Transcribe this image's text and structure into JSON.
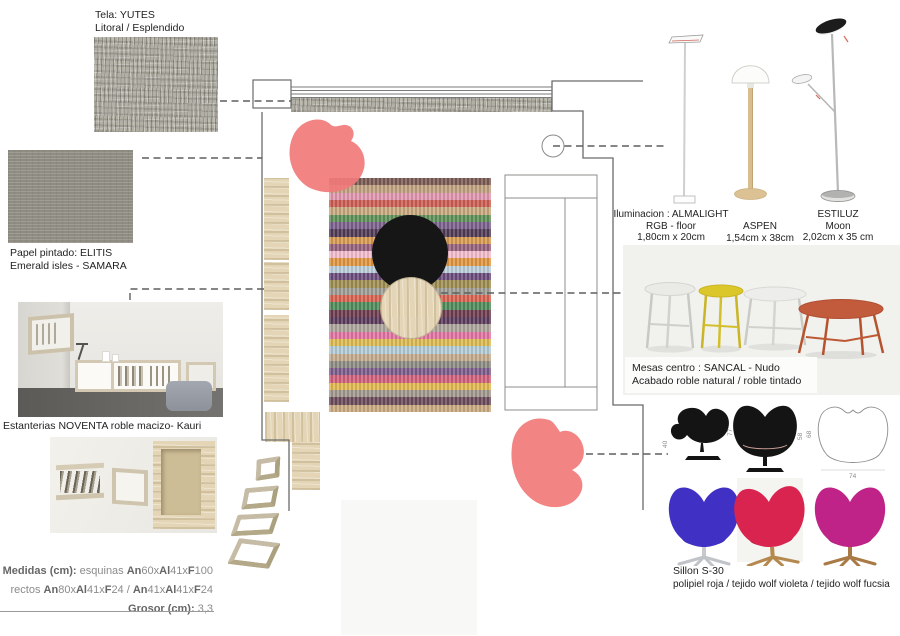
{
  "fabric": {
    "label_line1": "Tela: YUTES",
    "label_line2": "Litoral / Esplendido"
  },
  "wallpaper": {
    "caption_line1": "Papel pintado: ELITIS",
    "caption_line2": "Emerald isles - SAMARA"
  },
  "shelving": {
    "caption": "Estanterias NOVENTA roble macizo- Kauri",
    "measurements": {
      "line1": [
        {
          "t": "Medidas (cm): ",
          "b": true
        },
        {
          "t": "esquinas ",
          "b": false
        },
        {
          "t": "An",
          "b": true
        },
        {
          "t": "60x",
          "b": false
        },
        {
          "t": "Al",
          "b": true
        },
        {
          "t": "41x",
          "b": false
        },
        {
          "t": "F",
          "b": true
        },
        {
          "t": "100",
          "b": false
        }
      ],
      "line2": [
        {
          "t": "rectos ",
          "b": false
        },
        {
          "t": "An",
          "b": true
        },
        {
          "t": "80x",
          "b": false
        },
        {
          "t": "Al",
          "b": true
        },
        {
          "t": "41x",
          "b": false
        },
        {
          "t": "F",
          "b": true
        },
        {
          "t": "24 / ",
          "b": false
        },
        {
          "t": "An",
          "b": true
        },
        {
          "t": "41x",
          "b": false
        },
        {
          "t": "Al",
          "b": true
        },
        {
          "t": "41x",
          "b": false
        },
        {
          "t": "F",
          "b": true
        },
        {
          "t": "24",
          "b": false
        }
      ],
      "line3": [
        {
          "t": "Grosor (cm): ",
          "b": true
        },
        {
          "t": "3,3",
          "b": false
        }
      ]
    }
  },
  "lighting": {
    "almalight": {
      "line1": "Iluminacion :  ALMALIGHT",
      "line2": "RGB - floor",
      "line3": "1,80cm x 20cm"
    },
    "aspen": {
      "line1": "ASPEN",
      "line2": "1,54cm x 38cm"
    },
    "estiluz": {
      "line1": "ESTILUZ",
      "line2": "Moon",
      "line3": "2,02cm x 35 cm"
    }
  },
  "tables": {
    "caption_line1": "Mesas centro : SANCAL - Nudo",
    "caption_line2": "Acabado roble natural / roble tintado",
    "colors": {
      "t1_top": "#eaeae6",
      "t2_top": "#dcc72b",
      "t3_top": "#ededeb",
      "t4_top": "#c25a3c"
    }
  },
  "armchair": {
    "caption_line1": "Sillon S-30",
    "caption_line2": "polipiel roja / tejido wolf violeta / tejido wolf fucsia",
    "dims": {
      "side_height": "40",
      "front_height": "77",
      "seat_height": "58",
      "top_depth": "68",
      "top_width": "74"
    },
    "colors": {
      "violet": "#4130c4",
      "violet_shade": "#2e1e9e",
      "red": "#d92450",
      "red_shade": "#ad1038",
      "fuchsia": "#c02387",
      "fuchsia_shade": "#970f63"
    }
  },
  "plan": {
    "accent_color": "#f17979",
    "rug_stripes": [
      "#7a5a52",
      "#c0a07e",
      "#e095ae",
      "#cc5c50",
      "#c8a87e",
      "#5e9158",
      "#7b5f8c",
      "#503a56",
      "#d89a50",
      "#96627c",
      "#f2bccb",
      "#df963f",
      "#b9cdd9",
      "#6b4b7c",
      "#9d8d50",
      "#9d9d95",
      "#d9624f",
      "#4f8c5c",
      "#6e3c4e",
      "#5c3c5c",
      "#aba49b",
      "#e273a2",
      "#dcba50",
      "#b2cad6",
      "#c4ab8c",
      "#8c8c84",
      "#7c5c8c",
      "#d0607c",
      "#e2b84e",
      "#a0988e",
      "#6a4a5a",
      "#c9a97f"
    ]
  }
}
